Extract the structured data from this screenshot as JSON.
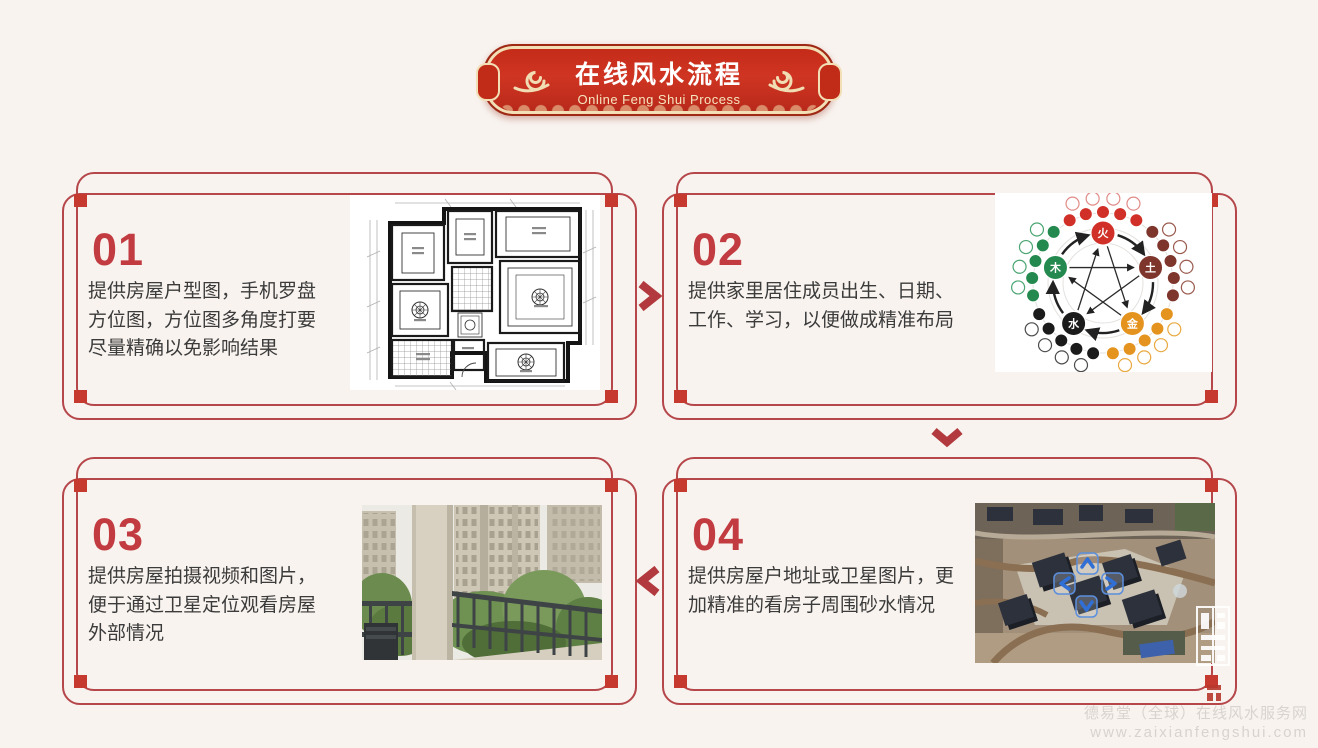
{
  "header": {
    "title": "在线风水流程",
    "subtitle": "Online Feng Shui Process"
  },
  "steps": [
    {
      "number": "01",
      "text": "提供房屋户型图，手机罗盘\n方位图，方位图多角度打要\n尽量精确以免影响结果",
      "image": "floor-plan"
    },
    {
      "number": "02",
      "text": "提供家里居住成员出生、日期、\n工作、学习，以便做成精准布局",
      "image": "five-elements-diagram"
    },
    {
      "number": "03",
      "text": "提供房屋拍摄视频和图片，\n便于通过卫星定位观看房屋\n外部情况",
      "image": "balcony-photo"
    },
    {
      "number": "04",
      "text": "提供房屋户地址或卫星图片，更\n加精准的看房子周围砂水情况",
      "image": "satellite-photo"
    }
  ],
  "wuxing": {
    "elements": [
      {
        "char": "火",
        "color": "#d03028",
        "ring": "#e08a86",
        "angle": -90
      },
      {
        "char": "土",
        "color": "#7e352c",
        "ring": "#9a5a4e",
        "angle": -18
      },
      {
        "char": "金",
        "color": "#e5931f",
        "ring": "#e9a83f",
        "angle": 54
      },
      {
        "char": "水",
        "color": "#1b1b1b",
        "ring": "#4a4a4a",
        "angle": 126
      },
      {
        "char": "木",
        "color": "#23894e",
        "ring": "#4aa571",
        "angle": 198
      }
    ]
  },
  "footer": {
    "line1": "德易堂（全球）在线风水服务网",
    "line2": "www.zaixianfengshui.com"
  },
  "colors": {
    "accent_red": "#c5392f",
    "border_red": "#b5464a",
    "banner_red": "#c32a17",
    "banner_gold": "#f2dfb6",
    "page_bg": "#f8f3ef",
    "text": "#3b3b3b",
    "watermark": "#d8d3cf"
  }
}
